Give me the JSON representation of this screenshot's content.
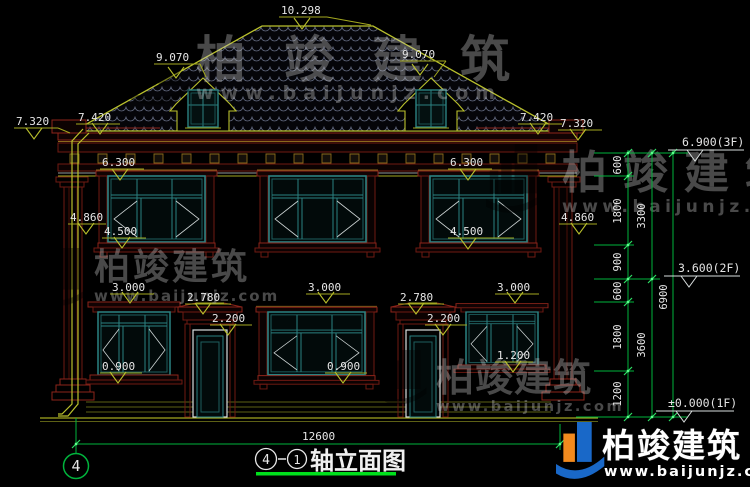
{
  "drawing": {
    "title": {
      "axis_start": "4",
      "axis_end": "1",
      "name": "轴立面图"
    },
    "axis_bubble": "4",
    "total_width_dim": "12600"
  },
  "dims": {
    "ridge": "10.298",
    "dormer": "9.070",
    "eave_side": "7.320",
    "eave_main": "7.420",
    "win2_head": "6.300",
    "mid_band": "4.860",
    "win2_sill": "4.500",
    "win1_head": "3.000",
    "canopy_top": "2.780",
    "door_head": "2.200",
    "win1_sill": "0.900",
    "win1_sill_right": "1.200"
  },
  "chain": {
    "v600": "600",
    "v1800": "1800",
    "v900": "900",
    "v1200": "1200",
    "v3300": "3300",
    "v3600": "3600",
    "v6900": "6900"
  },
  "levels": {
    "third": "6.900(3F)",
    "second": "3.600(2F)",
    "first": "±0.000(1F)"
  },
  "brand": {
    "name": "柏竣建筑",
    "url": "www.baijunjz.com"
  },
  "colors": {
    "line_green": "#00b33c",
    "line_olive": "#a3a81f",
    "frame_teal": "#2b8181",
    "band_red": "#6f1a12",
    "underline_green": "#00e01c"
  }
}
